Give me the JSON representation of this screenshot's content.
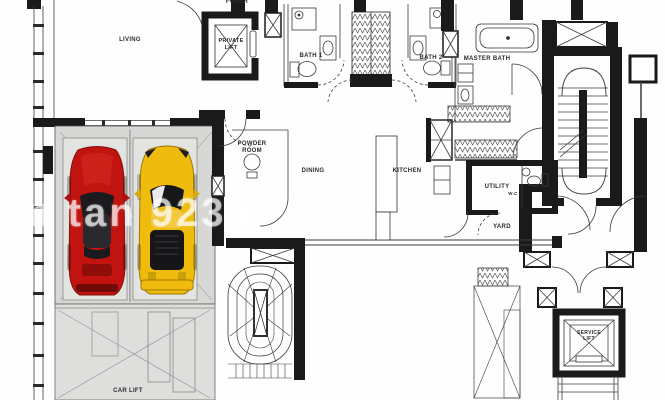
{
  "plan": {
    "type": "apartment-floor-plan",
    "watermark": "in tan 9235",
    "rooms": {
      "living": "LIVING",
      "foyer": "FOYER",
      "private_lift": "PRIVATE LIFT",
      "bath1": "BATH 1",
      "bath2": "BATH 2",
      "master_bath": "MASTER BATH",
      "powder_room": "POWDER ROOM",
      "dining": "DINING",
      "kitchen": "KITCHEN",
      "utility": "UTILITY",
      "wc": "W.C",
      "yard": "YARD",
      "car_lift": "CAR LIFT",
      "service_lift": "SERVICE LIFT"
    },
    "colors": {
      "wall": "#1a1a1a",
      "line": "#3c3c3c",
      "garage_fill": "#d7d7d5",
      "car_red": "#c11410",
      "car_yellow": "#efbb0d",
      "watermark_color": "rgba(255,255,255,0.62)"
    }
  }
}
